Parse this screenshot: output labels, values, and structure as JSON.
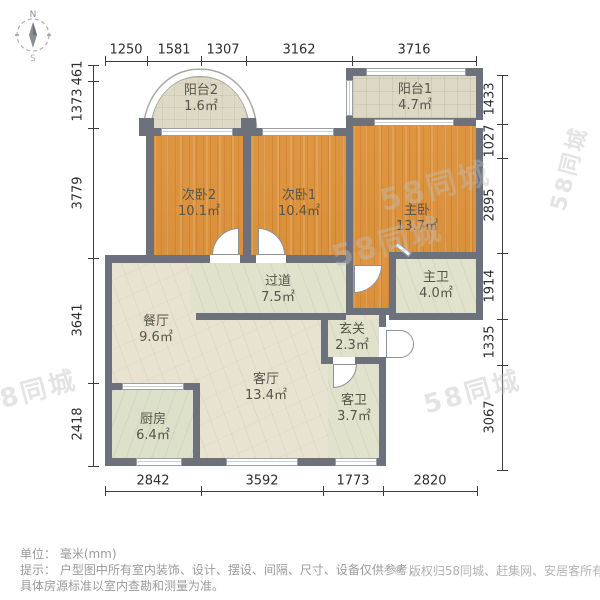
{
  "compass": {
    "north": "N",
    "south": "S"
  },
  "dimensions": {
    "top": [
      "1250",
      "1581",
      "1307",
      "3162",
      "3716"
    ],
    "left": [
      "461",
      "1373",
      "3779",
      "3641",
      "2418"
    ],
    "right": [
      "1433",
      "1027",
      "2895",
      "1914",
      "1335",
      "3067"
    ],
    "bottom": [
      "2842",
      "3592",
      "1773",
      "2820"
    ]
  },
  "rooms": [
    {
      "id": "balcony2",
      "name": "阳台2",
      "area": "1.6㎡"
    },
    {
      "id": "balcony1",
      "name": "阳台1",
      "area": "4.7㎡"
    },
    {
      "id": "bedroom2",
      "name": "次卧2",
      "area": "10.1㎡"
    },
    {
      "id": "bedroom1",
      "name": "次卧1",
      "area": "10.4㎡"
    },
    {
      "id": "master",
      "name": "主卧",
      "area": "13.7㎡"
    },
    {
      "id": "masterbath",
      "name": "主卫",
      "area": "4.0㎡"
    },
    {
      "id": "corridor",
      "name": "过道",
      "area": "7.5㎡"
    },
    {
      "id": "dining",
      "name": "餐厅",
      "area": "9.6㎡"
    },
    {
      "id": "entry",
      "name": "玄关",
      "area": "2.3㎡"
    },
    {
      "id": "living",
      "name": "客厅",
      "area": "13.4㎡"
    },
    {
      "id": "guestbath",
      "name": "客卫",
      "area": "3.7㎡"
    },
    {
      "id": "kitchen",
      "name": "厨房",
      "area": "6.4㎡"
    }
  ],
  "notes": {
    "unit": "单位： 毫米(mm)",
    "tip_line1": "提示： 户型图中所有室内装饰、设计、摆设、间隔、尺寸、设备仅供参考，",
    "tip_line2": "具体房源标准以室内查勘和测量为准。",
    "copyright": "© 版权归58同城、赶集网、安居客所有"
  },
  "watermark": "58同城",
  "colors": {
    "wall": "#6d717b",
    "bedroom_floor": "#dc9340",
    "living_floor": "#e8e2d1",
    "wet_floor": "#e0e2cb",
    "kitchen_floor": "#dce0c8",
    "balcony_floor": "#dcd8c3",
    "dim_text": "#2d2d2d",
    "note_text": "#9b9b9b",
    "watermark_gray": "#bebebe"
  }
}
